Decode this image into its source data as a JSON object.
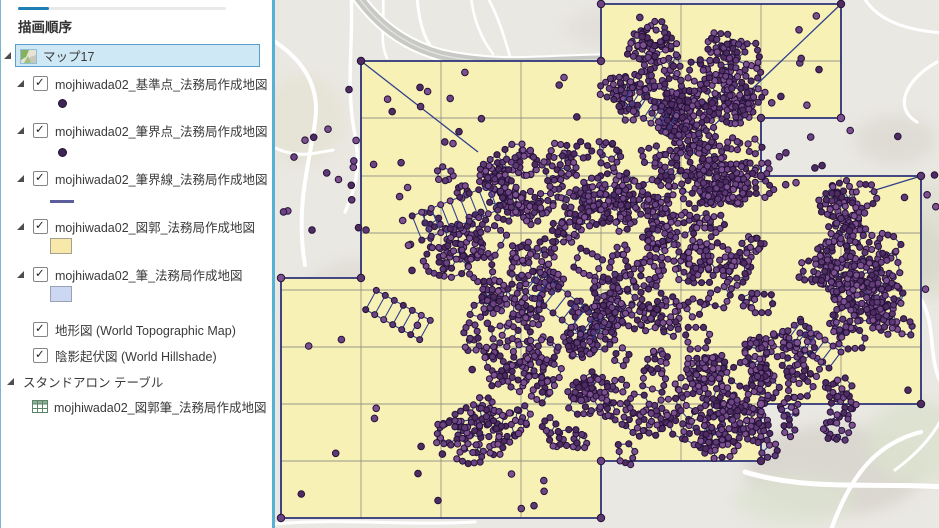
{
  "panel": {
    "title": "描画順序",
    "map_group": {
      "label": "マップ17",
      "selected": true
    },
    "layers": [
      {
        "label": "mojhiwada02_基準点_法務局作成地図",
        "checked": true,
        "symbol": "point"
      },
      {
        "label": "mojhiwada02_筆界点_法務局作成地図",
        "checked": true,
        "symbol": "point"
      },
      {
        "label": "mojhiwada02_筆界線_法務局作成地図",
        "checked": true,
        "symbol": "line"
      },
      {
        "label": "mojhiwada02_図郭_法務局作成地図",
        "checked": true,
        "symbol": "fill-yellow"
      },
      {
        "label": "mojhiwada02_筆_法務局作成地図",
        "checked": true,
        "symbol": "fill-blue"
      },
      {
        "label": "地形図 (World Topographic Map)",
        "checked": true
      },
      {
        "label": "陰影起伏図 (World Hillshade)",
        "checked": true
      }
    ],
    "standalone_section": {
      "label": "スタンドアロン テーブル"
    },
    "standalone_table": {
      "label": "mojhiwada02_図郭筆_法務局作成地図"
    },
    "symbol_colors": {
      "point": "#3f2457",
      "line": "#5b5e9b",
      "fill_yellow": "#f7e9a9",
      "fill_blue": "#ccd7f2"
    }
  },
  "map": {
    "seed": 11,
    "colors": {
      "bg": "#eae8e2",
      "sheet": "#f8f1b5",
      "edge": "#2c3178",
      "grid": "#98968c",
      "net": "#30408f",
      "dotStroke": "#251239",
      "dotFills": [
        "#4e2c62",
        "#5e3a74",
        "#6d4483",
        "#7d508f"
      ],
      "road": "#ffffff",
      "hwy": "#c8c9c5",
      "hwyStripe": "#e4e4e0"
    },
    "union": [
      [
        86,
        61
      ],
      [
        326,
        61
      ],
      [
        326,
        4
      ],
      [
        566,
        4
      ],
      [
        566,
        118
      ],
      [
        486,
        118
      ],
      [
        486,
        176
      ],
      [
        646,
        176
      ],
      [
        646,
        404
      ],
      [
        486,
        404
      ],
      [
        486,
        461
      ],
      [
        326,
        461
      ],
      [
        326,
        518
      ],
      [
        6,
        518
      ],
      [
        6,
        278
      ],
      [
        86,
        278
      ]
    ],
    "grid": {
      "cols": [
        86,
        166,
        246,
        326,
        406,
        486,
        566,
        646
      ],
      "rows": [
        4,
        61,
        118,
        176,
        233,
        290,
        347,
        404,
        461,
        518
      ]
    },
    "diagonals": [
      [
        566,
        4,
        432,
        132
      ],
      [
        646,
        176,
        594,
        192
      ],
      [
        86,
        61,
        203,
        152
      ]
    ],
    "highway": {
      "d": "M 78 -10 C 100 22 126 44 166 55 C 232 70 282 58 348 60",
      "casing": 13,
      "width": 9
    },
    "roads": [
      [
        "M -6 38 C 24 56 46 82 40 122 C 35 162 20 205 30 265",
        4
      ],
      [
        "M 76 -5 C 79 40 70 85 80 135 C 86 168 80 190 70 212",
        3.4
      ],
      [
        "M 142 -5 C 144 28 152 48 168 58",
        3
      ],
      [
        "M 0 148 C 22 158 36 154 58 150",
        3
      ],
      [
        "M 470 472 C 535 492 605 482 668 487",
        5
      ],
      [
        "M 556 530 C 576 474 602 443 646 432",
        4.2
      ],
      [
        "M 645 298 C 662 322 652 362 668 386",
        3.6
      ],
      [
        "M 662 62 C 630 80 618 108 642 122",
        3.2
      ],
      [
        "M 588 -4 C 600 18 626 30 668 33",
        3
      ],
      [
        "M 108 -4 C 110 22 104 42 112 58",
        2.6
      ],
      [
        "M 196 -4 C 198 18 206 38 218 54",
        2.6
      ],
      [
        "M 236 60 C 230 40 225 20 212 -4",
        2.6
      ],
      [
        "M 0 524 C 60 518 130 526 200 522",
        3
      ],
      [
        "M 620 470 C 640 455 655 440 666 420",
        3
      ]
    ],
    "hills": [
      [
        600,
        255,
        70,
        45,
        "#d5d1c8",
        0.85
      ],
      [
        560,
        470,
        90,
        45,
        "#d7d4cc",
        0.85
      ],
      [
        80,
        340,
        70,
        80,
        "#dddad3",
        0.7
      ],
      [
        620,
        140,
        40,
        25,
        "#dbd8d0",
        0.75
      ],
      [
        350,
        28,
        60,
        22,
        "#dedbd4",
        0.6
      ],
      [
        640,
        442,
        48,
        42,
        "#dbe1cf",
        0.9
      ],
      [
        520,
        500,
        60,
        25,
        "#dce2d1",
        0.8
      ],
      [
        28,
        120,
        40,
        45,
        "#e5e3d3",
        0.85
      ],
      [
        660,
        240,
        30,
        60,
        "#d9dcca",
        0.6
      ]
    ],
    "clusters": [
      {
        "n": 280,
        "circles": [
          [
            205,
            200,
            45
          ],
          [
            255,
            180,
            42
          ],
          [
            305,
            185,
            45
          ],
          [
            355,
            190,
            45
          ],
          [
            405,
            180,
            40
          ],
          [
            330,
            235,
            60
          ],
          [
            262,
            242,
            55
          ],
          [
            212,
            272,
            50
          ],
          [
            292,
            302,
            62
          ],
          [
            372,
            282,
            58
          ],
          [
            432,
            242,
            52
          ],
          [
            442,
            302,
            52
          ],
          [
            382,
            352,
            58
          ],
          [
            302,
            372,
            55
          ],
          [
            232,
            332,
            45
          ],
          [
            252,
            402,
            48
          ],
          [
            332,
            422,
            48
          ],
          [
            412,
            402,
            45
          ],
          [
            462,
            362,
            45
          ],
          [
            465,
            175,
            32
          ],
          [
            470,
            390,
            42
          ],
          [
            512,
            362,
            40
          ],
          [
            542,
            402,
            38
          ],
          [
            502,
            422,
            32
          ],
          [
            178,
            238,
            32
          ],
          [
            205,
            430,
            30
          ],
          [
            448,
            430,
            28
          ]
        ]
      },
      {
        "n": 62,
        "circles": [
          [
            378,
            62,
            28
          ],
          [
            412,
            82,
            36
          ],
          [
            450,
            66,
            30
          ],
          [
            458,
            100,
            26
          ],
          [
            416,
            118,
            28
          ],
          [
            352,
            92,
            24
          ]
        ]
      },
      {
        "n": 48,
        "circles": [
          [
            576,
            215,
            26
          ],
          [
            590,
            250,
            30
          ],
          [
            600,
            290,
            30
          ],
          [
            580,
            320,
            28
          ],
          [
            562,
            272,
            26
          ],
          [
            618,
            312,
            20
          ]
        ]
      }
    ],
    "ladders": [
      [
        142,
        228,
        218,
        198,
        26,
        8
      ],
      [
        258,
        282,
        322,
        332,
        24,
        7
      ],
      [
        352,
        96,
        396,
        124,
        20,
        6
      ],
      [
        520,
        330,
        560,
        360,
        20,
        5
      ],
      [
        96,
        300,
        150,
        330,
        22,
        6
      ]
    ],
    "scatter": [
      {
        "x": 6,
        "y": 66,
        "w": 78,
        "h": 205,
        "n": 16
      },
      {
        "x": 92,
        "y": 68,
        "w": 230,
        "h": 88,
        "n": 15
      },
      {
        "x": 330,
        "y": 66,
        "w": 152,
        "h": 50,
        "n": 8
      },
      {
        "x": 488,
        "y": 124,
        "w": 150,
        "h": 46,
        "n": 7
      },
      {
        "x": 492,
        "y": 182,
        "w": 148,
        "h": 215,
        "n": 13
      },
      {
        "x": 10,
        "y": 290,
        "w": 305,
        "h": 220,
        "n": 24
      },
      {
        "x": 90,
        "y": 162,
        "w": 66,
        "h": 122,
        "n": 9
      },
      {
        "x": 495,
        "y": 12,
        "w": 66,
        "h": 100,
        "n": 8
      },
      {
        "x": 335,
        "y": 12,
        "w": 36,
        "h": 40,
        "n": 3
      },
      {
        "x": 648,
        "y": 128,
        "w": 14,
        "h": 230,
        "n": 4
      }
    ]
  }
}
